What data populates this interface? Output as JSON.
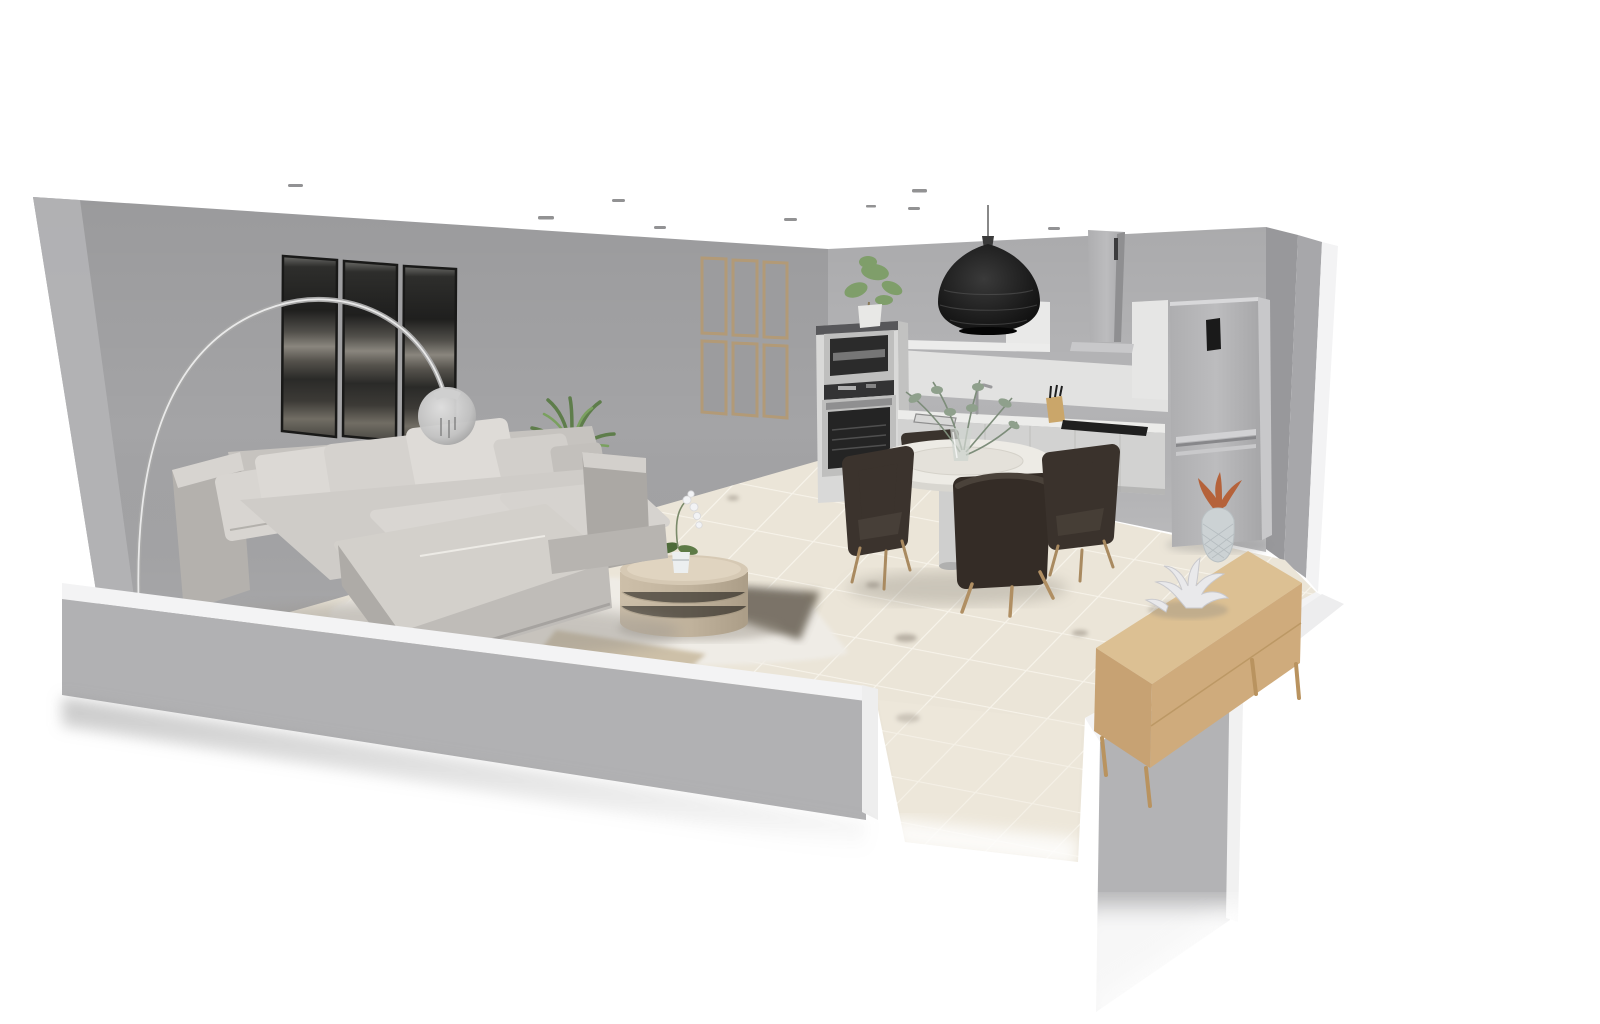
{
  "scene": {
    "title": "3D dollhouse render of an open-plan living room and kitchen",
    "view": "isometric cutaway with half-height front walls",
    "room_type": "living room + kitchen / dining"
  },
  "palette": {
    "exterior": "#ffffff",
    "wall_left": "#a4a4a6",
    "wall_left_edge": "#b4b4b6",
    "wall_back": "#b5b5b7",
    "wall_slab_a": "#98989b",
    "wall_slab_b": "#a7a7aa",
    "cap_white": "#f3f3f4",
    "front_wall_face": "#b1b1b3",
    "right_wall_face": "#b3b3b5",
    "floor_tile": "#e8e1d2",
    "grout": "#f6f2e7",
    "rug_cream": "#efece6",
    "rug_tan": "#c8b99e",
    "shadow_patch": "#5e564a",
    "sofa_fabric": "#d6d3cf",
    "sofa_shade": "#b2afab",
    "artwork_dark": "#2e2e2c",
    "frame_wood": "#b29a77",
    "steel": "#b9b9bb",
    "pendant_black": "#1d1d1d",
    "counter_white": "#e9e9e8",
    "cabinet_white": "#d9d9d8",
    "oven_glass": "#242424",
    "chair_espresso": "#39312b",
    "wood_leg": "#ae8d61",
    "sideboard_top": "#dcc093",
    "sideboard_side": "#c7a273",
    "plant_green": "#6a8f55",
    "pineapple_leaf": "#b5623a",
    "pineapple_body": "#ccd2d4",
    "coral_white": "#e9e9eb",
    "table_top": "#edebe5"
  },
  "objects": [
    {
      "name": "left-wall",
      "description": "tall grey wall with triptych artwork and panel mirror"
    },
    {
      "name": "back-wall",
      "description": "tall grey kitchen wall"
    },
    {
      "name": "right-wall-slabs",
      "description": "tall grey wall returns at back-right corner"
    },
    {
      "name": "front-half-walls",
      "description": "low cut walls with white caps and door gap"
    },
    {
      "name": "tiled-floor",
      "description": "beige ceramic tile floor with white grout"
    },
    {
      "name": "ceiling-downlights",
      "description": "small recessed spots seen edge-on"
    },
    {
      "name": "triptych-artwork",
      "description": "three dark abstract panels"
    },
    {
      "name": "panel-mirror",
      "description": "six wood-framed panes on far left wall"
    },
    {
      "name": "arc-floor-lamp",
      "description": "chrome arc lamp with glass globe shade"
    },
    {
      "name": "sectional-sofa",
      "description": "light grey chaise sectional with pillows"
    },
    {
      "name": "yucca-plant",
      "description": "green plant behind sofa arm"
    },
    {
      "name": "cream-rug",
      "description": "shaggy cream rug with tan band and dark patch"
    },
    {
      "name": "coffee-table",
      "description": "round travertine drum table"
    },
    {
      "name": "orchid",
      "description": "white potted orchid on coffee table"
    },
    {
      "name": "oven-column",
      "description": "tall cabinet with microwave and oven"
    },
    {
      "name": "cabinet-plant",
      "description": "small green plant on oven column"
    },
    {
      "name": "kitchen-counter",
      "description": "white base cabinets with worktop"
    },
    {
      "name": "sink-and-faucet",
      "description": "inset sink with chrome tap"
    },
    {
      "name": "knife-block",
      "description": "wooden block with knives"
    },
    {
      "name": "cooktop",
      "description": "black induction hob"
    },
    {
      "name": "range-hood",
      "description": "stainless chimney hood"
    },
    {
      "name": "wall-shelf",
      "description": "white box shelf on back wall"
    },
    {
      "name": "pendant-lamp",
      "description": "black woven pendant over worktop"
    },
    {
      "name": "fridge-freezer",
      "description": "stainless fridge with black control panel"
    },
    {
      "name": "dining-table",
      "description": "round white pedestal table"
    },
    {
      "name": "dining-chairs",
      "description": "four espresso tub chairs with wood legs"
    },
    {
      "name": "vase-greenery",
      "description": "glass vase with eucalyptus"
    },
    {
      "name": "sideboard",
      "description": "low oak sideboard along right wall"
    },
    {
      "name": "coral-decor",
      "description": "white coral sculpture"
    },
    {
      "name": "pineapple-decor",
      "description": "ceramic pineapple with copper leaves"
    }
  ]
}
